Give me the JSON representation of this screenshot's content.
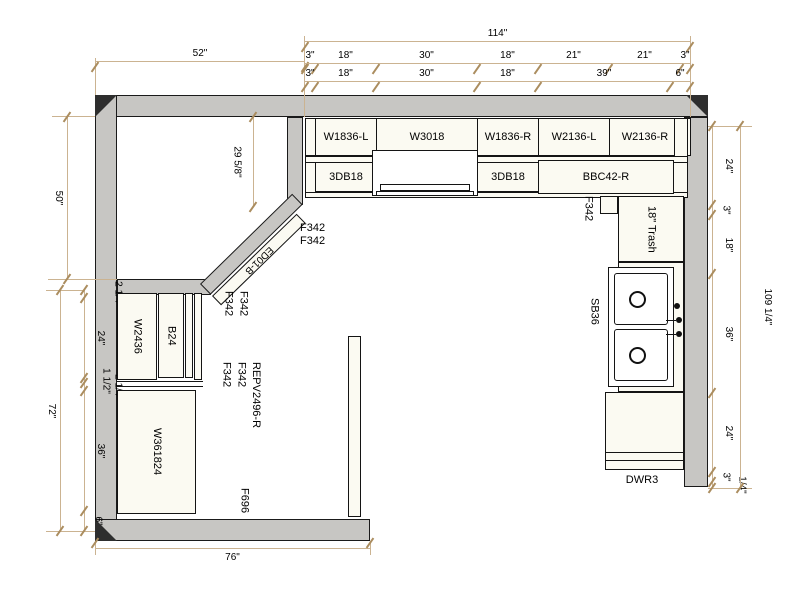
{
  "dimensions": {
    "top_left_wall": "52\"",
    "top_overall": "114\"",
    "top_chain_upper": [
      "3\"",
      "18\"",
      "30\"",
      "18\"",
      "21\"",
      "21\"",
      "3\""
    ],
    "top_chain_lower": [
      "3\"",
      "18\"",
      "30\"",
      "18\"",
      "39\"",
      "6\""
    ],
    "left_upper": "50\"",
    "left_overall": "72\"",
    "left_chain": [
      "2 1/4\"",
      "24\"",
      "1 1/2\"",
      "2 1/4\"",
      "36\"",
      "6\""
    ],
    "right_chain": [
      "24\"",
      "3\"",
      "18\"",
      "36\"",
      "24\"",
      "3\"",
      "1/4\""
    ],
    "right_overall": "109 1/4\"",
    "corner_depth": "29 5/8\"",
    "bottom_wall": "76\""
  },
  "cabinets": {
    "wall_row": [
      "W1836-L",
      "W3018",
      "W1836-R",
      "W2136-L",
      "W2136-R"
    ],
    "base_row": [
      "3DB18",
      "3DB18",
      "BBC42-R"
    ],
    "diagonal": "ED01-B",
    "right_run": {
      "filler": "F342",
      "trash": "18\" Trash",
      "sink_base": "SB36",
      "dishwasher": "DWR3"
    },
    "left_run": {
      "wall": "W2436",
      "base": "B24",
      "tall": "W361824",
      "filler": "F696"
    },
    "filler_notes": {
      "corner": [
        "F342",
        "F342"
      ],
      "left_upper": [
        "F342",
        "F342"
      ],
      "left_lower": [
        "F342",
        "F342",
        "REPV2496-R"
      ]
    }
  }
}
